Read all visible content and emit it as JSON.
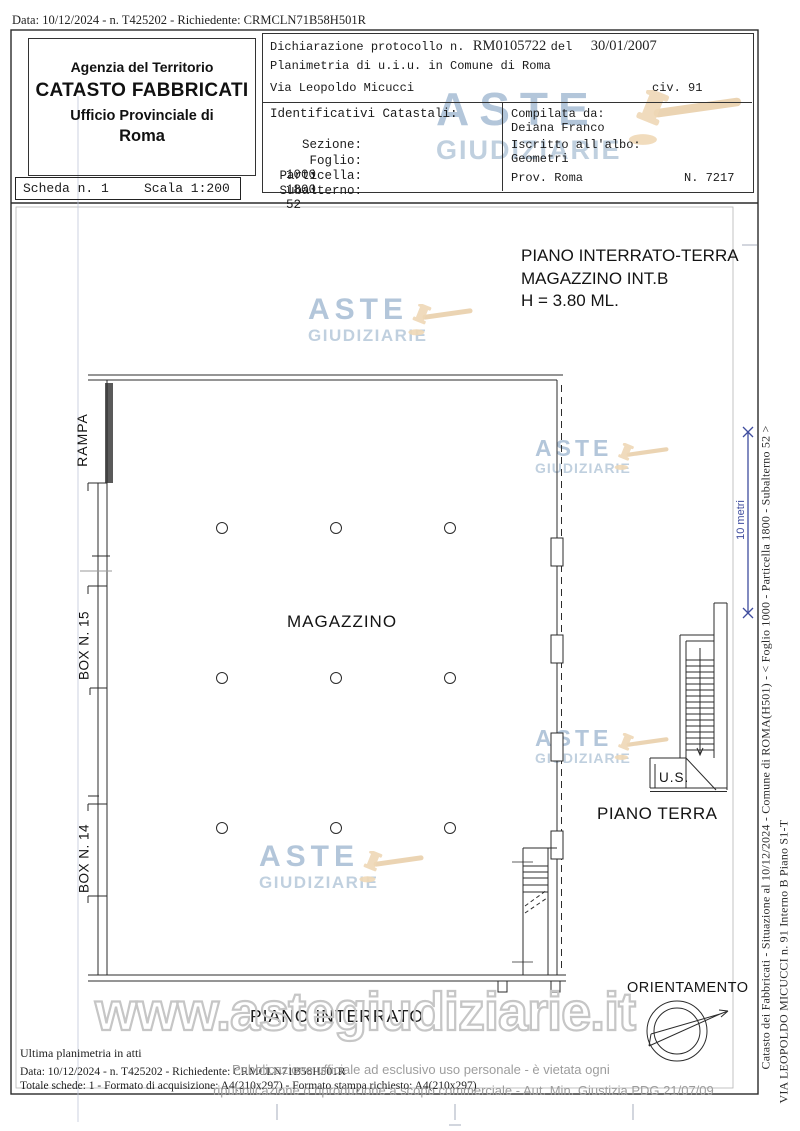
{
  "page": {
    "top_line": "Data: 10/12/2024 - n. T425202 - Richiedente: CRMCLN71B58H501R"
  },
  "header": {
    "agency": {
      "line1": "Agenzia del Territorio",
      "line2": "CATASTO FABBRICATI",
      "line3": "Ufficio Provinciale di",
      "line4": "Roma"
    },
    "scheda": {
      "label": "Scheda n. 1",
      "scale": "Scala 1:200"
    },
    "declaration": {
      "line1_prefix": "Dichiarazione protocollo n.",
      "protocol": "RM0105722",
      "del": "del",
      "date": "30/01/2007",
      "line2": "Planimetria di u.i.u. in Comune di Roma",
      "line3": "Via Leopoldo Micucci",
      "civ": "civ. 91"
    },
    "identifiers": {
      "title": "Identificativi Catastali:",
      "rows": [
        {
          "label": "Sezione:",
          "value": ""
        },
        {
          "label": "Foglio:",
          "value": "1000"
        },
        {
          "label": "Particella:",
          "value": "1800"
        },
        {
          "label": "Subalterno:",
          "value": "52"
        }
      ]
    },
    "compiler": {
      "compilata_label": "Compilata da:",
      "compilata_value": "Deiana Franco",
      "albo_label": "Iscritto all'albo:",
      "albo_value": "Geometri",
      "prov": "Prov. Roma",
      "n": "N. 7217"
    }
  },
  "plan": {
    "title_line1": "PIANO INTERRATO-TERRA",
    "title_line2": "MAGAZZINO INT.B",
    "title_line3": "H = 3.80 ML.",
    "labels": {
      "rampa": "RAMPA",
      "box15": "BOX N. 15",
      "box14": "BOX N. 14",
      "magazzino": "MAGAZZINO",
      "piano_interrato": "PIANO INTERRATO",
      "us": "U.S.",
      "piano_terra": "PIANO TERRA",
      "orientamento": "ORIENTAMENTO",
      "scalebar": "10 metri"
    }
  },
  "margin": {
    "line1": "Catasto dei Fabbricati - Situazione al 10/12/2024 - Comune di ROMA(H501) - < Foglio 1000 - Particella 1800 - Subalterno 52 >",
    "line2": "VIA LEOPOLDO MICUCCI n. 91  Interno B Piano S1-T"
  },
  "footer": {
    "line1": "Ultima planimetria in atti",
    "line2": "Data: 10/12/2024 - n. T425202 - Richiedente: CRMCLN71B58H501R",
    "line3": "Totale schede: 1 - Formato di acquisizione: A4(210x297)  - Formato stampa richiesto: A4(210x297)",
    "overlay1": "Pubblicazione ufficiale ad esclusivo uso personale - è vietata ogni",
    "overlay2": "ripubblicazione o riproduzione a scopo commerciale - Aut. Min. Giustizia PDG 21/07/09"
  },
  "watermark": {
    "aste": "ASTE",
    "giudiziarie": "GIUDIZIARIE",
    "url": "www.astegiudiziarie.it"
  },
  "colors": {
    "watermark_blue": "#b3c6da",
    "gavel_tan": "#efd8b6",
    "scalebar_blue": "#3f4d9e",
    "overlay_gray": "#9d9d9d"
  }
}
